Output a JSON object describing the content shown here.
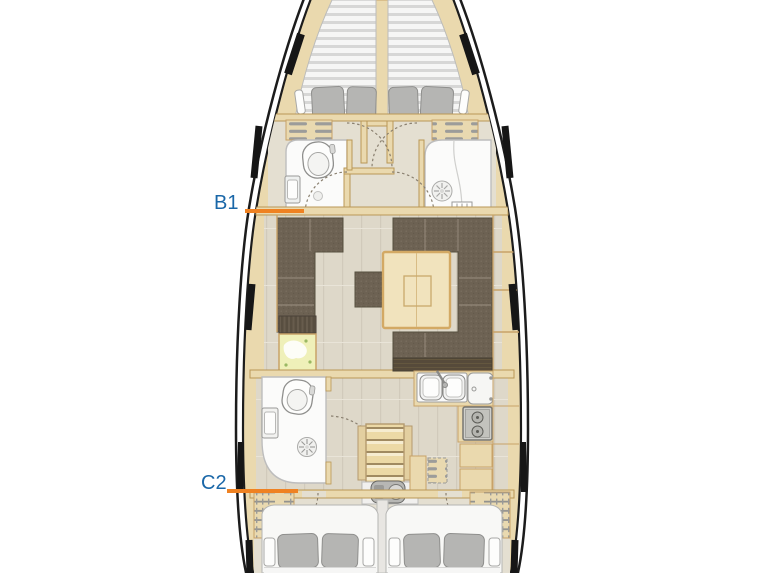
{
  "annotations": {
    "b1": {
      "label": "B1"
    },
    "c2": {
      "label": "C2"
    }
  },
  "colors": {
    "label_blue": "#1A67A8",
    "pointer_orange": "#EF8222",
    "hull_black": "#1C1C1C",
    "hull_wood_trim": "#EAD9AE",
    "wood_border": "#C8A268",
    "floor_beige": "#DED8C9",
    "corridor_floor": "#E4DFD1",
    "upholstery_brown": "#6D6253",
    "table_wood": "#F1E3BD",
    "fixture_white": "#FBFBFA",
    "pillow_gray": "#B4B4B4",
    "mattress_stripe_gray": "#D7D7D7",
    "chart_map_yellow": "#EFF0B9"
  }
}
